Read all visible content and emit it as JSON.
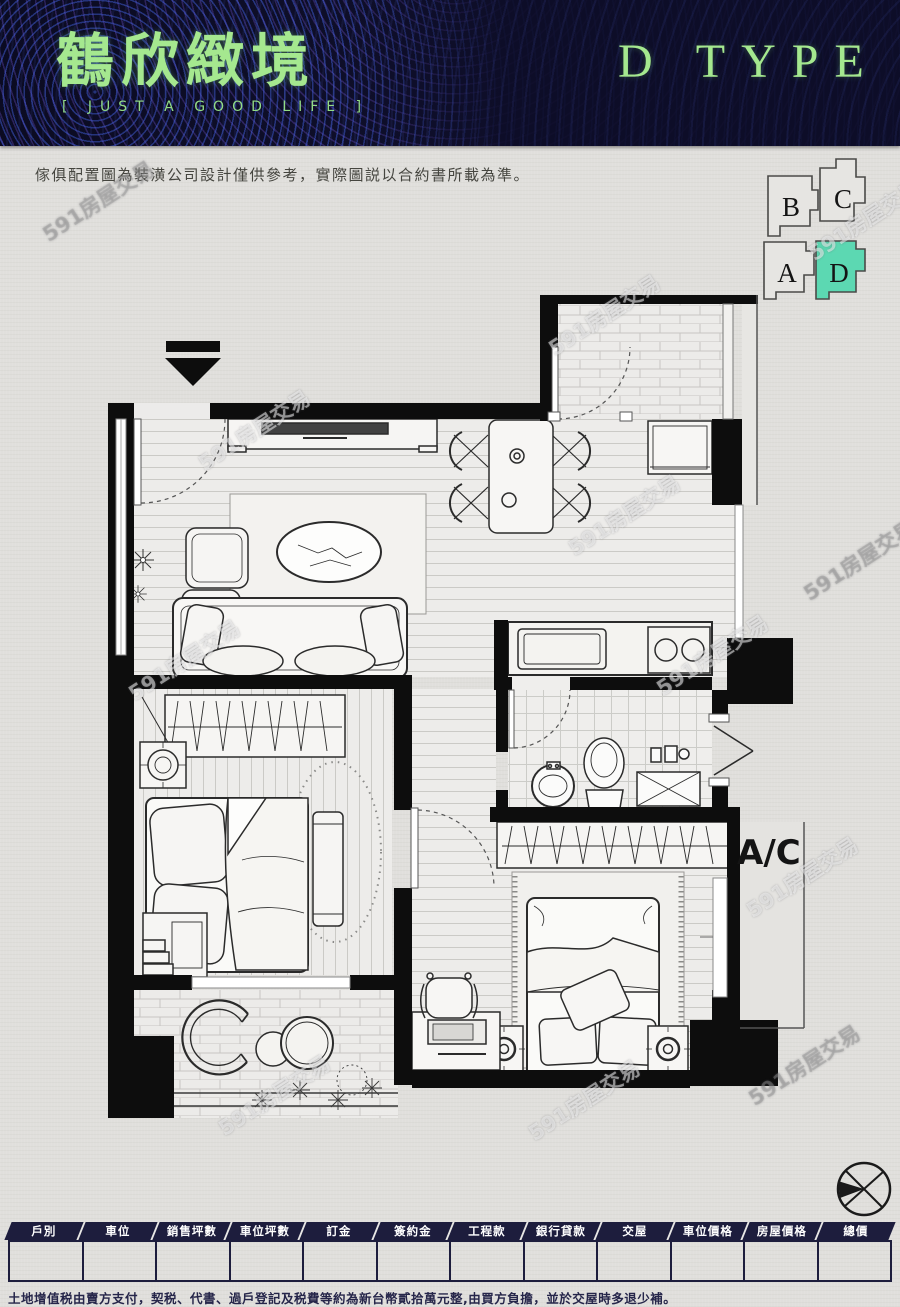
{
  "page": {
    "title_logo": "鶴欣緻境",
    "slogan": "[ JUST A GOOD LIFE ]",
    "plan_type": "D TYPE"
  },
  "disclaimer": "傢俱配置圖為裝潢公司設計僅供參考，實際圖説以合約書所載為準。",
  "unit_key": {
    "units": [
      {
        "label": "B",
        "highlighted": false
      },
      {
        "label": "C",
        "highlighted": false
      },
      {
        "label": "A",
        "highlighted": false
      },
      {
        "label": "D",
        "highlighted": true
      }
    ],
    "highlight_color": "#5cd8b2"
  },
  "floor_plan": {
    "ac_label": "A/C",
    "icons": [
      "entry-arrow-icon",
      "compass-icon"
    ]
  },
  "watermark": {
    "text": "591房屋交易"
  },
  "table": {
    "headers": [
      "戶別",
      "車位",
      "銷售坪數",
      "車位坪數",
      "訂金",
      "簽約金",
      "工程款",
      "銀行貸款",
      "交屋",
      "車位價格",
      "房屋價格",
      "總價"
    ],
    "row": [
      "",
      "",
      "",
      "",
      "",
      "",
      "",
      "",
      "",
      "",
      "",
      ""
    ]
  },
  "footnote": "土地增值税由賣方支付，契税、代書、過戶登記及税費等約為新台幣貳拾萬元整,由買方負擔，並於交屋時多退少補。",
  "colors": {
    "header_bg": "#0e0e28",
    "accent_green": "#a5e88f",
    "table_navy": "#1d1d3d",
    "unit_highlight": "#5cd8b2",
    "wall_black": "#0d0d0d",
    "paper": "#e0dfdc"
  }
}
